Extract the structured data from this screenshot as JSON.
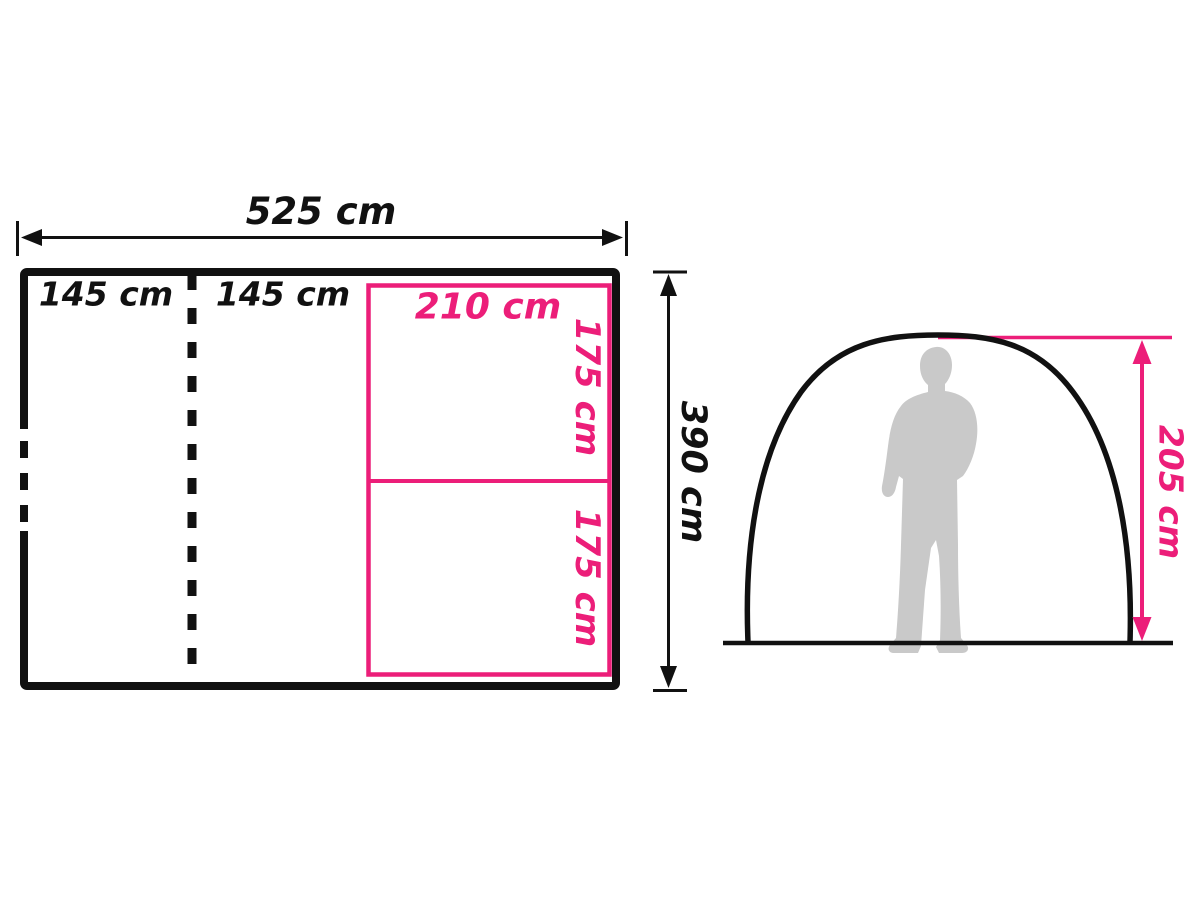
{
  "colors": {
    "dimension_black": "#111111",
    "accent_pink": "#EC1E79",
    "silhouette_gray": "#C9C9C9",
    "background": "#FFFFFF"
  },
  "floor_plan": {
    "overall_width_label": "525 cm",
    "overall_depth_label": "390 cm",
    "left_section_label": "145 cm",
    "middle_section_label": "145 cm",
    "sleeping_area_width_label": "210 cm",
    "sleeping_cabin_top_label": "175 cm",
    "sleeping_cabin_bottom_label": "175 cm"
  },
  "side_view": {
    "peak_height_label": "205 cm"
  }
}
